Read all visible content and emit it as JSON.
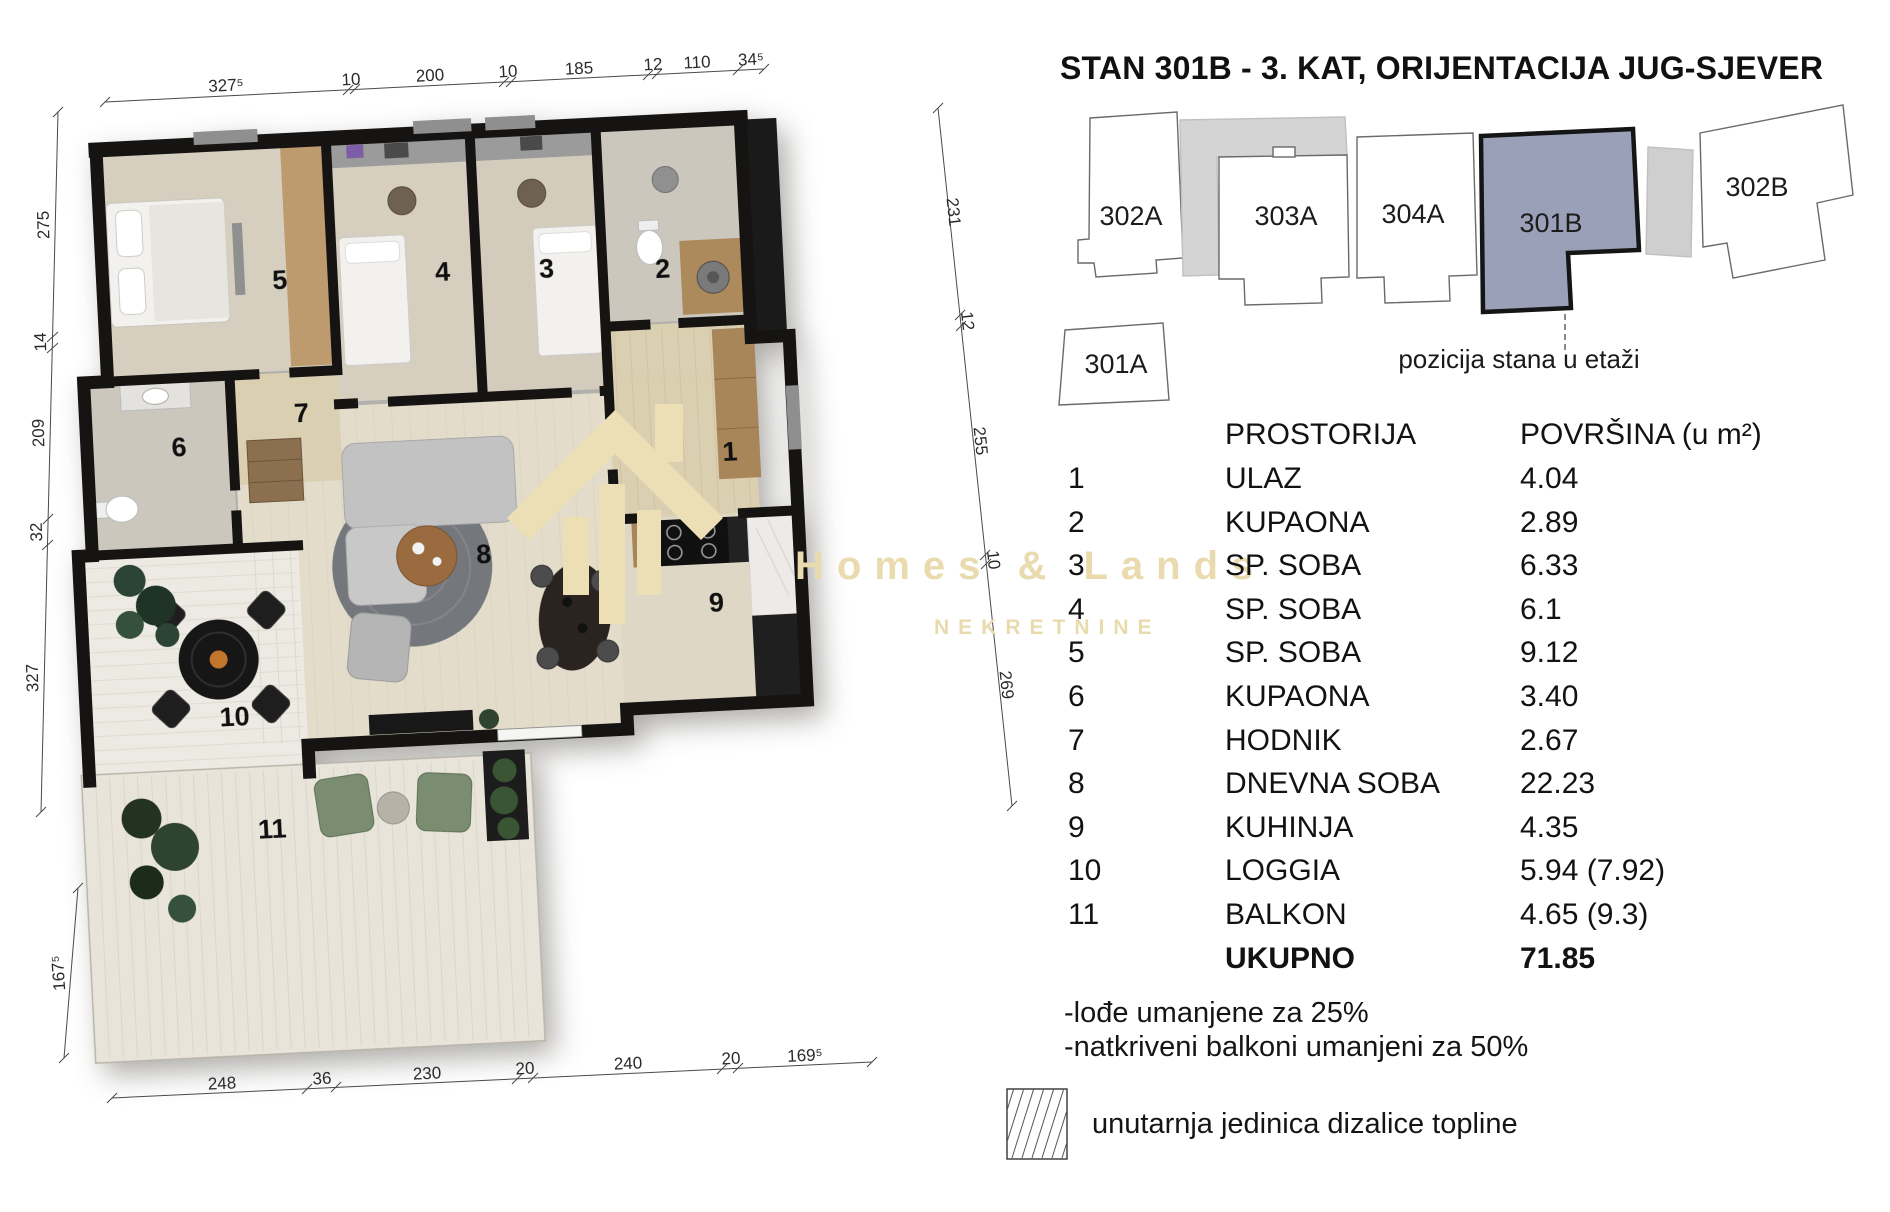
{
  "title": "STAN 301B - 3. KAT, ORIJENTACIJA JUG-SJEVER",
  "watermark": {
    "brand": "Homes & Lands",
    "subtitle": "NEKRETNINE"
  },
  "position_diagram": {
    "caption": "pozicija stana u etaži",
    "highlight_color": "#9aa0b8",
    "units": [
      {
        "id": "302A",
        "highlighted": false
      },
      {
        "id": "303A",
        "highlighted": false
      },
      {
        "id": "304A",
        "highlighted": false
      },
      {
        "id": "301B",
        "highlighted": true
      },
      {
        "id": "302B",
        "highlighted": false
      },
      {
        "id": "301A",
        "highlighted": false
      }
    ]
  },
  "area_table": {
    "header": {
      "room": "PROSTORIJA",
      "area": "POVRŠINA (u m²)"
    },
    "rows": [
      {
        "num": "1",
        "name": "ULAZ",
        "area": "4.04"
      },
      {
        "num": "2",
        "name": "KUPAONA",
        "area": "2.89"
      },
      {
        "num": "3",
        "name": "SP. SOBA",
        "area": "6.33"
      },
      {
        "num": "4",
        "name": "SP. SOBA",
        "area": "6.1"
      },
      {
        "num": "5",
        "name": "SP. SOBA",
        "area": "9.12"
      },
      {
        "num": "6",
        "name": "KUPAONA",
        "area": "3.40"
      },
      {
        "num": "7",
        "name": "HODNIK",
        "area": "2.67"
      },
      {
        "num": "8",
        "name": "DNEVNA SOBA",
        "area": "22.23"
      },
      {
        "num": "9",
        "name": "KUHINJA",
        "area": "4.35"
      },
      {
        "num": "10",
        "name": "LOGGIA",
        "area": "5.94  (7.92)"
      },
      {
        "num": "11",
        "name": "BALKON",
        "area": "4.65  (9.3)"
      }
    ],
    "total": {
      "label": "UKUPNO",
      "value": "71.85"
    }
  },
  "notes": {
    "line1": "-lođe umanjene za 25%",
    "line2": "-natkriveni balkoni umanjeni za 50%"
  },
  "legend": {
    "label": "unutarnja jedinica dizalice topline"
  },
  "floorplan": {
    "room_labels": {
      "r1": "1",
      "r2": "2",
      "r3": "3",
      "r4": "4",
      "r5": "5",
      "r6": "6",
      "r7": "7",
      "r8": "8",
      "r9": "9",
      "r10": "10",
      "r11": "11"
    },
    "dims": {
      "top": [
        "327⁵",
        "10",
        "200",
        "10",
        "185",
        "12",
        "110",
        "34⁵"
      ],
      "left": [
        "275",
        "14",
        "209",
        "32",
        "327",
        "167⁵"
      ],
      "right": [
        "231",
        "12",
        "255",
        "10",
        "269"
      ],
      "bottom": [
        "248",
        "36",
        "230",
        "20",
        "240",
        "20",
        "169⁵"
      ]
    }
  }
}
